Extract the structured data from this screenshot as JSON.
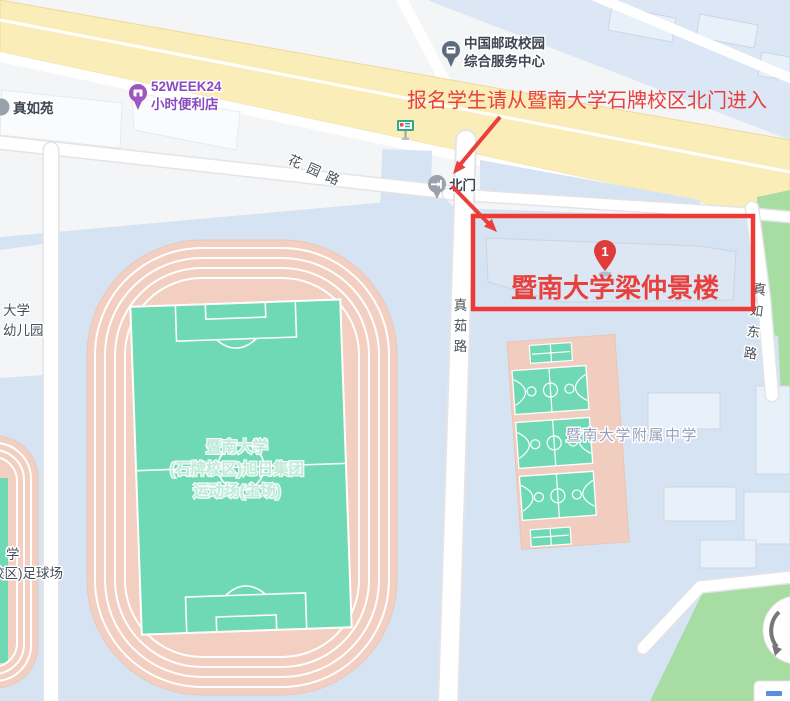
{
  "overlay": {
    "notice": "报名学生请从暨南大学石牌校区北门进入",
    "building_label": "暨南大学梁仲景楼",
    "marker_number": "1"
  },
  "pois": {
    "zhenruyuan": {
      "label": "真如苑"
    },
    "week52": {
      "lines": [
        "52WEEK24",
        "小时便利店"
      ]
    },
    "china_post": {
      "lines": [
        "中国邮政校园",
        "综合服务中心"
      ]
    },
    "north_gate": {
      "label": "北门"
    },
    "affiliated_school": {
      "label": "暨南大学附属中学"
    }
  },
  "roads": {
    "huayuan": "花园路",
    "zhenru": "真茹路",
    "zhenru_east": "真如东路"
  },
  "areas": {
    "stadium": {
      "lines": [
        "暨南大学",
        "(石牌校区)旭日集团",
        "运动场(主场)"
      ]
    },
    "kindergarten": {
      "lines": [
        "大学",
        "幼儿园"
      ]
    },
    "football": {
      "lines": [
        "学",
        "校区)足球场"
      ]
    }
  },
  "colors": {
    "accent_red": "#e8403d",
    "rect_red": "#ee3a35",
    "highway_yellow": "#faedb8",
    "campus_blue": "#d5e3f2",
    "track_salmon": "#f2cfc0",
    "field_teal": "#6fd9b6",
    "park_green": "#a7dca2",
    "poi_purple": "#8a4bbf"
  }
}
